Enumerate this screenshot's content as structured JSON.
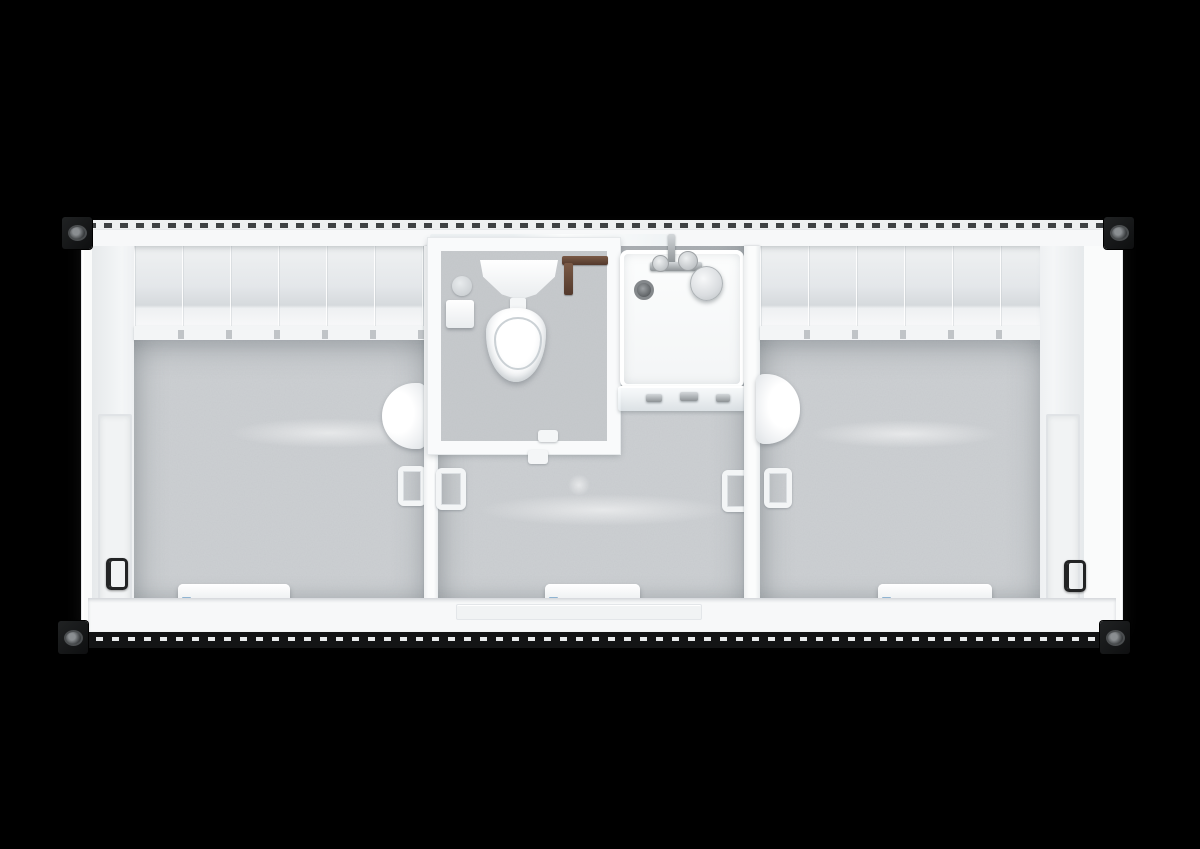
{
  "scene": {
    "description": "Top-down cutaway 3D render of a white modular sanitary container on a black background: two changing rooms flanking a central washroom with WC cubicle and open shower",
    "background_color": "#000000"
  },
  "palette": {
    "shell_white": "#fafbfb",
    "wall_panel_gray": "#e4e7ea",
    "floor_speckled_gray": "#cdd0d3",
    "corner_casting_black": "#131415",
    "chrome_fittings": "#a9adb1",
    "supply_pipe_brown": "#5f4636",
    "heater_label_blue": "#8fb4d2"
  },
  "labels": {
    "container": "Sanitary container unit, top view cutaway",
    "top_rail": "Corrugated top side rail",
    "bottom_rail": "Corrugated bottom side rail",
    "corner_casting": "ISO corner casting",
    "west_end_wall": "Left end wall with door",
    "east_end_wall": "Right end wall with door",
    "door_handle_black": "Exterior door handle",
    "door_handle_white": "Interior door handle",
    "left_room": "Left changing room",
    "right_room": "Right changing room",
    "vestibule": "Central washroom / vestibule",
    "wall_paneling": "Paneled wall face",
    "coat_hook_rail": "Shelf rail with coat hooks",
    "floor": "Speckled vinyl floor",
    "heater": "Electric convector heater",
    "wall_lamp": "Oval wall lamp",
    "wc_room": "WC cubicle",
    "toilet_tank": "Toilet cistern",
    "toilet_bowl": "Toilet bowl with seat",
    "toilet_roll_holder": "Toilet roll holder",
    "water_pipe": "Water supply pipe",
    "shower_tray": "Shower tray",
    "shower_drain": "Shower drain",
    "shower_mixer": "Chrome shower mixer tap",
    "shower_head": "Shower head",
    "shower_screen": "Glass shower screen",
    "entry_threshold": "Entry door threshold",
    "transom_glass": "Transom glazing above WC cubicle",
    "floor_sheen": "Light reflection on floor"
  },
  "counts": {
    "rooms": 3,
    "corner_castings": 4,
    "convector_heaters": 3,
    "wall_lamps": 2,
    "coat_hook_rails": 2,
    "exterior_door_handles": 2
  }
}
